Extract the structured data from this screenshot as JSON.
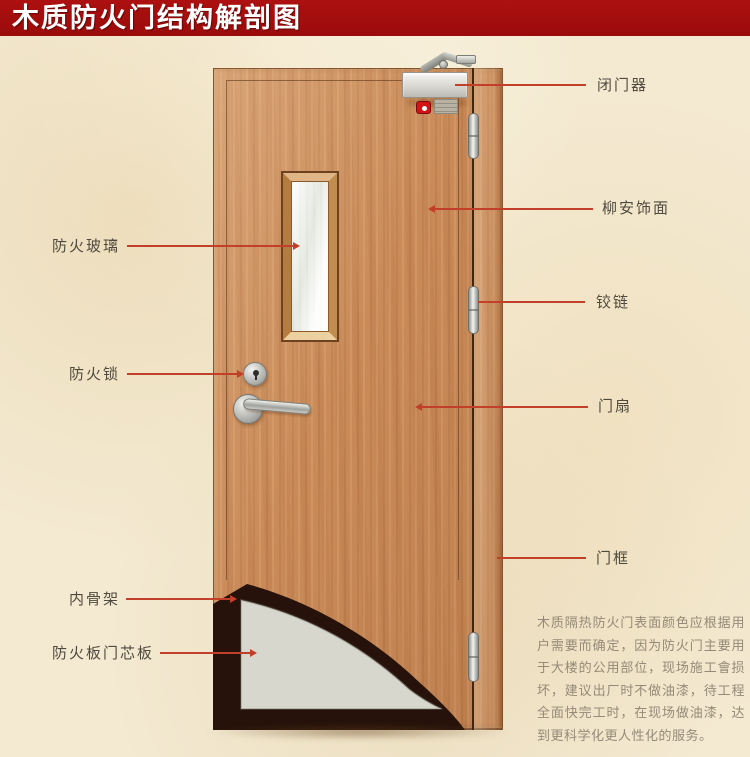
{
  "title": "木质防火门结构解剖图",
  "colors": {
    "banner": "#9b0b0b",
    "background": "#f4ead2",
    "callout_line": "#c2402a",
    "label_text": "#4f4a3d",
    "door_wood": "#ca8b59",
    "core_board_grey": "#d7d7ce",
    "inner_skeleton_dark": "#26120a"
  },
  "labels": {
    "left": [
      {
        "id": "fire-glass",
        "text": "防火玻璃"
      },
      {
        "id": "fire-lock",
        "text": "防火锁"
      },
      {
        "id": "inner-skeleton",
        "text": "内骨架"
      },
      {
        "id": "core-board",
        "text": "防火板门芯板"
      }
    ],
    "right": [
      {
        "id": "door-closer",
        "text": "闭门器"
      },
      {
        "id": "veneer",
        "text": "柳安饰面"
      },
      {
        "id": "hinge",
        "text": "铰链"
      },
      {
        "id": "door-leaf",
        "text": "门扇"
      },
      {
        "id": "door-frame",
        "text": "门框"
      }
    ]
  },
  "description": "木质隔热防火门表面颜色应根据用户需要而确定，因为防火门主要用于大楼的公用部位，现场施工會损坏，建议出厂时不做油漆，待工程全面快完工时，在现场做油漆，达到更科学化更人性化的服务。"
}
